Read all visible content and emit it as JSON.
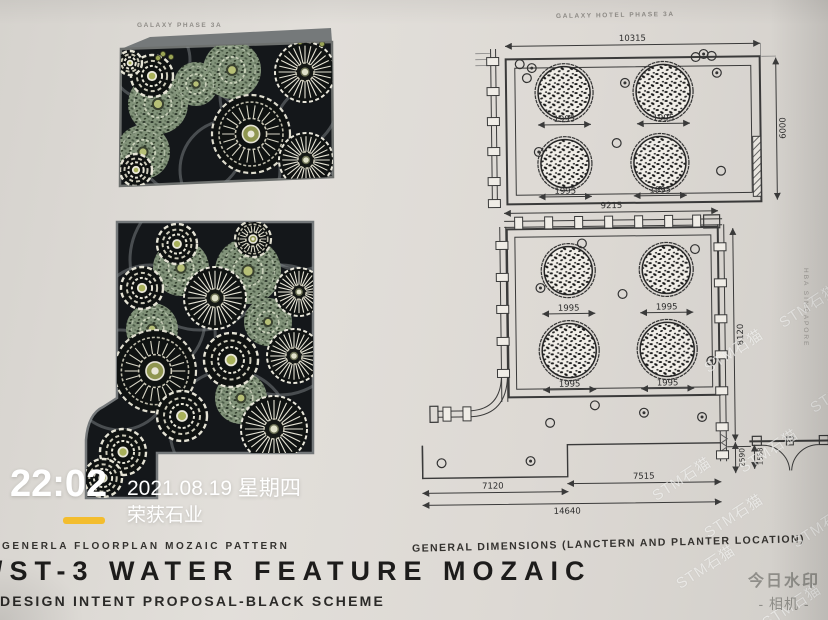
{
  "overlay": {
    "time": "22:02",
    "date": "2021.08.19 星期四",
    "brand": "荣获石业",
    "camera_app": {
      "line1": "今日水印",
      "line2": "- 相机 -"
    },
    "stock_watermark": "STM石猫"
  },
  "left_page": {
    "header": "GALAXY PHASE 3A",
    "caption": "GENERLA FLOORPLAN MOZAIC PATTERN",
    "title": "/ST-3 WATER FEATURE MOZAIC",
    "subtitle": "DESIGN INTENT PROPOSAL-BLACK SCHEME"
  },
  "right_page": {
    "header": "GALAXY HOTEL PHASE 3A",
    "caption": "GENERAL DIMENSIONS (LANCTERN AND PLANTER LOCATION)",
    "side_label": "HBA SINGAPORE",
    "upper_plan": {
      "top_dim": "10315",
      "right_dim": "6000",
      "planter_dim": "1995"
    },
    "lower_plan": {
      "top_dim": "9215",
      "right_dim": "8120",
      "right_dim2": "2590",
      "right_dim3": "1558",
      "bottom_dim_left": "7120",
      "bottom_dim_right": "7515",
      "bottom_dim_total": "14640",
      "planter_dim": "1995"
    }
  }
}
